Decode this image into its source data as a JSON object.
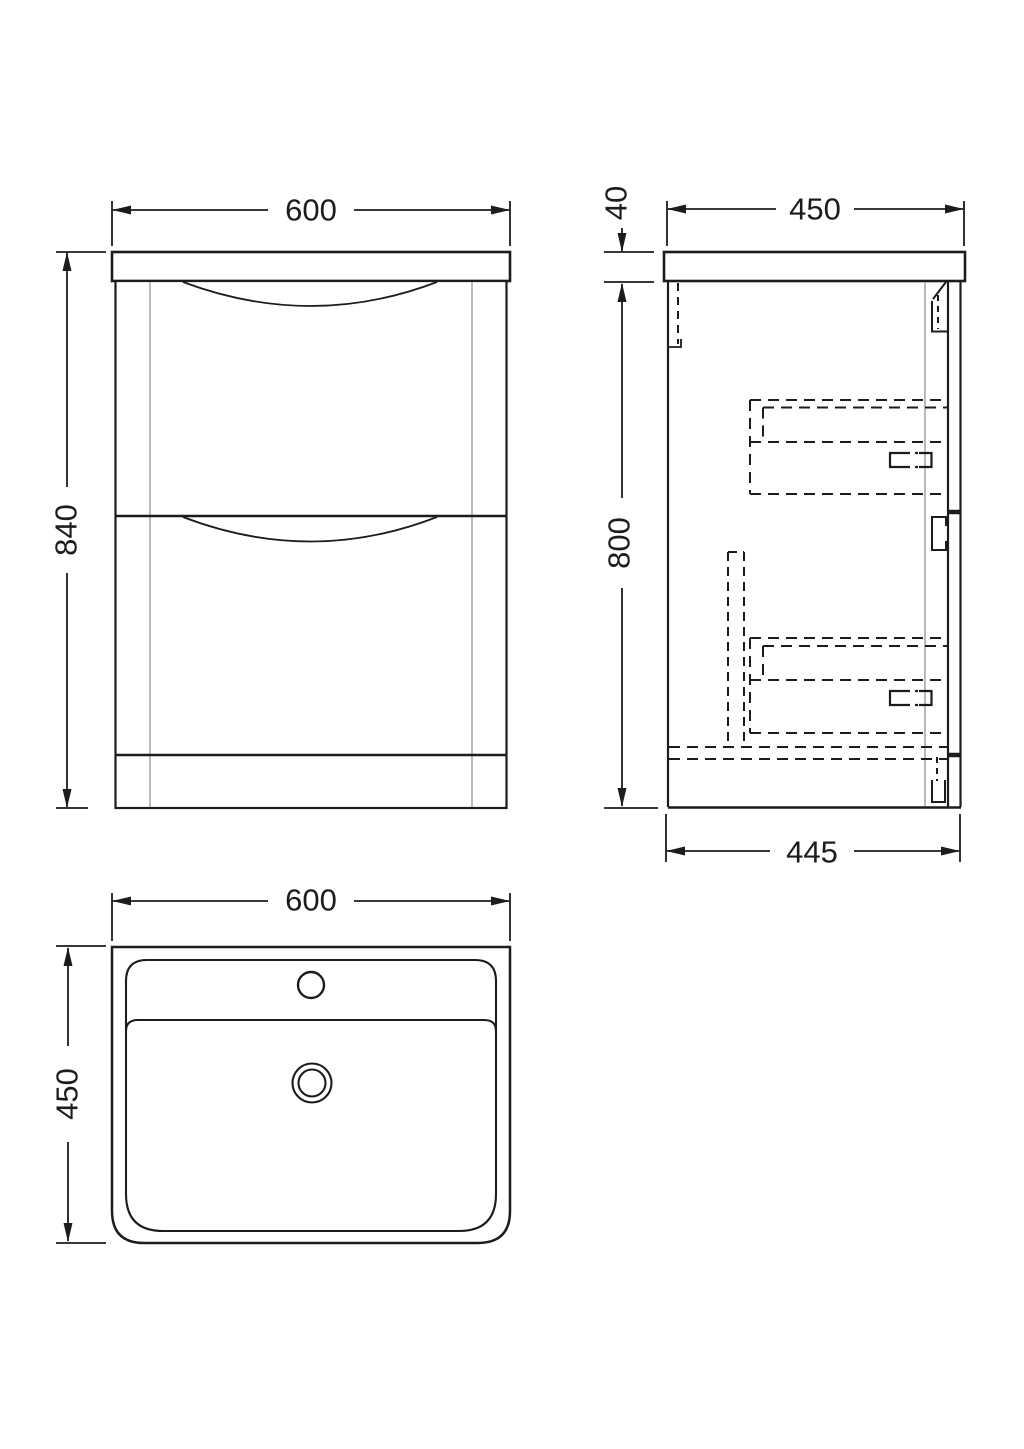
{
  "drawing": {
    "kind": "vanity-unit-orthographic-drawing",
    "line_color": "#1c1c1c",
    "thin_line_color": "#a8a8a8",
    "background": "#ffffff",
    "front_view": {
      "width": "600",
      "height": "840"
    },
    "side_view": {
      "worktop_thickness": "40",
      "depth": "450",
      "cabinet_height": "800",
      "base_depth": "445"
    },
    "plan_view": {
      "width": "600",
      "depth": "450"
    }
  }
}
